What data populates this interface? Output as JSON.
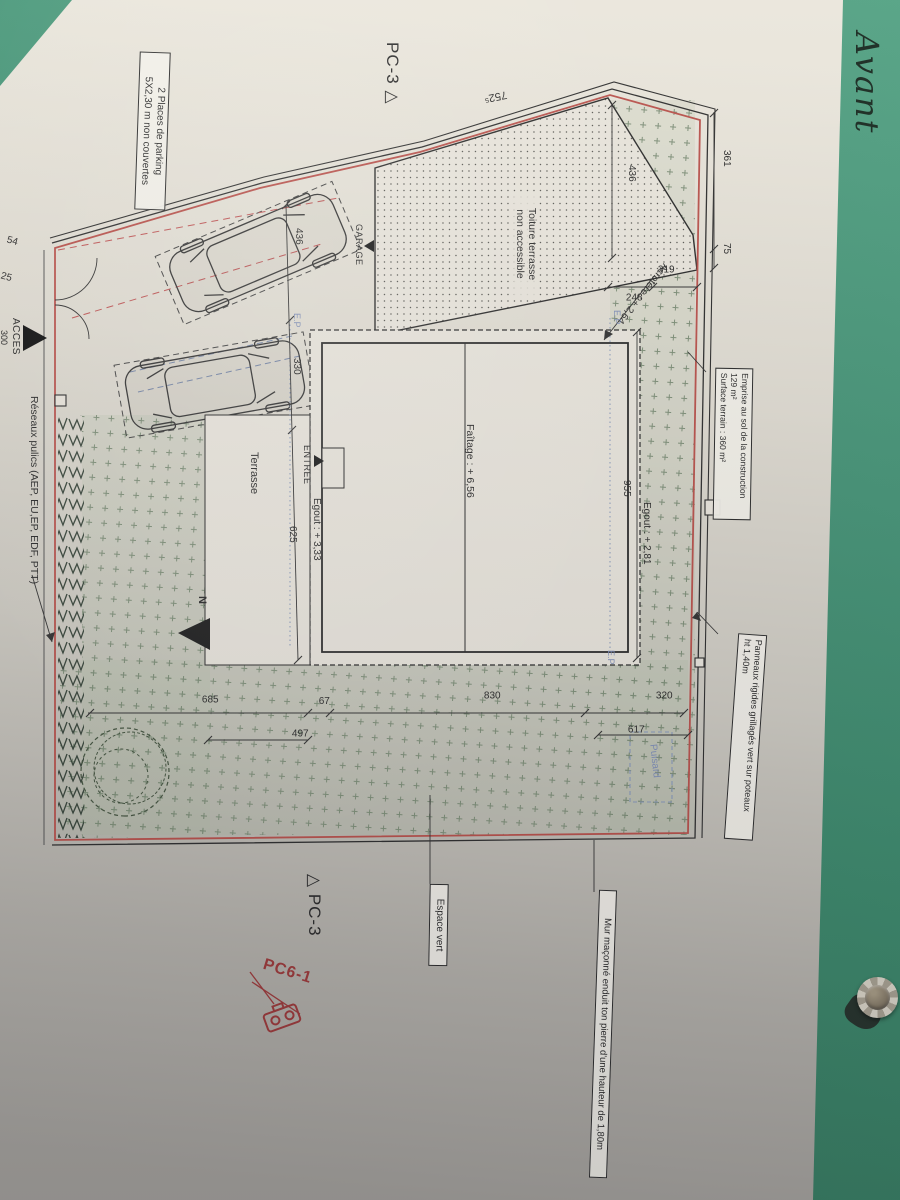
{
  "photo": {
    "handwriting_mark": "t",
    "handwriting": "Avant"
  },
  "plan": {
    "marker_top": "PC-3",
    "marker_bottom": "PC-3",
    "triangle_open": "△",
    "north_label": "N",
    "stamp_label": "PC6-1",
    "boxes": {
      "parking_line1": "2 Places de parking",
      "parking_line2": "5X2,30 m non couvertes",
      "emprise_line1": "Emprise au sol de la construction",
      "emprise_line2": "129 m²",
      "emprise_line3": "Surface terrain : 360 m²",
      "panneaux_line1": "Panneaux rigides grillagés vert sur poteaux",
      "panneaux_line2": "ht 1,40m",
      "espace_vert": "Espace vert",
      "mur": "Mur maçonné enduit ton pierre d'une hauteur de 1,80m"
    },
    "areas": {
      "toiture_line1": "Toiture terrasse",
      "toiture_line2": "non accessible",
      "terrasse": "Terrasse",
      "garage": "GARAGE",
      "entree": "ENTREE",
      "acces": "ACCES",
      "reseaux": "Réseaux pulics (AEP, EU,EP, EDF, PTT)",
      "puisard": "Puisard",
      "ep": "E.P"
    },
    "levels": {
      "acrotere": "Acrotère : + 2,64",
      "faitage": "Faîtage : + 6,56",
      "egout_left": "Egout : + 3,33",
      "egout_right": "Egout : + 2,81"
    },
    "dims": {
      "d752": "752⁵",
      "d361": "361",
      "d75": "75",
      "d436r": "436",
      "d319": "319",
      "d248": "248",
      "d436l": "436",
      "d330": "330",
      "d625": "625",
      "d955": "955",
      "d685": "685",
      "d67": "67",
      "d830": "830",
      "d320": "320",
      "d497": "497",
      "d617": "617",
      "d300": "300",
      "d54": "54",
      "d25": "25"
    },
    "colors": {
      "boundary_red": "#b9524c",
      "utility_blue": "#8090b8",
      "stamp_red": "#9e3a3a",
      "folder_green": "#3f8f70"
    }
  }
}
